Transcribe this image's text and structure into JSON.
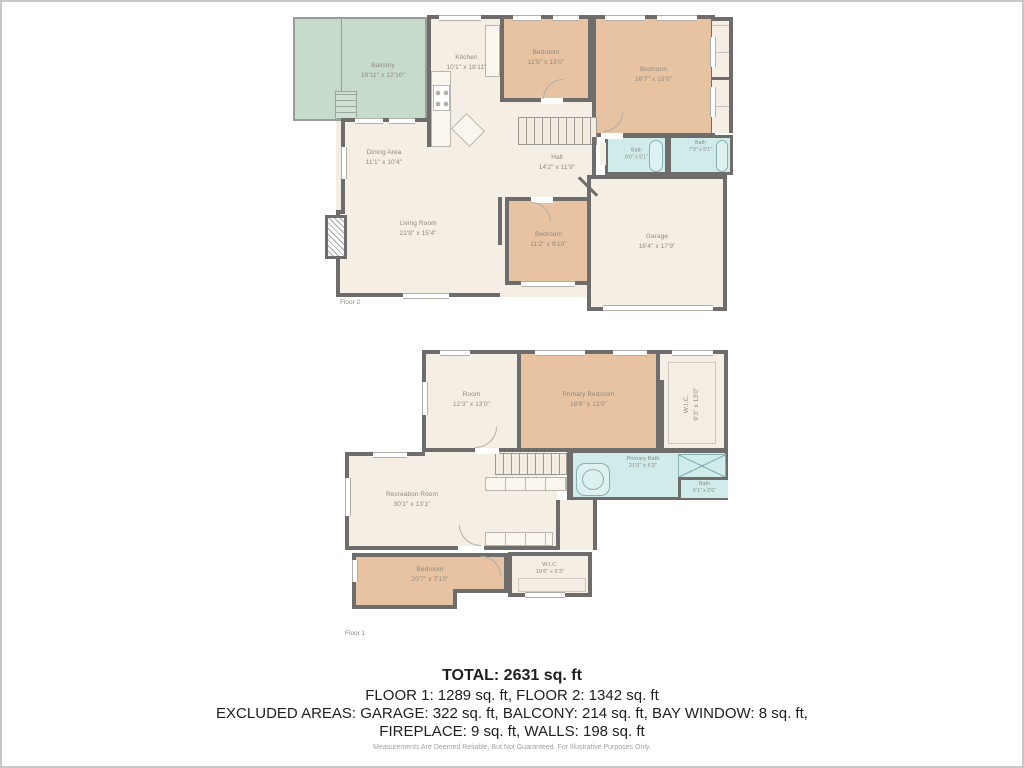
{
  "colors": {
    "wall": "#6e6d6b",
    "room_fill": "#f5eee5",
    "bedroom_fill": "#e7c3a1",
    "bath_fill": "#cfebea",
    "balcony_fill": "#c6dbca",
    "label_text": "#8e897f"
  },
  "floor2": {
    "label": "Floor 2",
    "rooms": {
      "balcony": {
        "name": "Balcony",
        "dims": "16'11\" x 12'10\""
      },
      "kitchen": {
        "name": "Kitchen",
        "dims": "10'1\" x 18'11\""
      },
      "bedroom_a": {
        "name": "Bedroom",
        "dims": "11'5\" x 13'0\""
      },
      "bedroom_b": {
        "name": "Bedroom",
        "dims": "16'7\" x 15'0\""
      },
      "dining": {
        "name": "Dining Area",
        "dims": "11'1\" x 10'4\""
      },
      "hall": {
        "name": "Hall",
        "dims": "14'2\" x 11'9\""
      },
      "bath_a": {
        "name": "Bath",
        "dims": "8'0\" x 5'1\""
      },
      "bath_b": {
        "name": "Bath",
        "dims": "7'9\" x 5'1\""
      },
      "living": {
        "name": "Living Room",
        "dims": "21'9\" x 15'4\""
      },
      "bedroom_c": {
        "name": "Bedroom",
        "dims": "11'2\" x 9'10\""
      },
      "garage": {
        "name": "Garage",
        "dims": "18'4\" x 17'9\""
      }
    }
  },
  "floor1": {
    "label": "Floor 1",
    "rooms": {
      "room": {
        "name": "Room",
        "dims": "12'3\" x 13'0\""
      },
      "primary_bedroom": {
        "name": "Primary Bedroom",
        "dims": "18'9\" x 13'0\""
      },
      "wic_upper": {
        "name": "W.I.C.",
        "dims": "9'3\" x 13'0\""
      },
      "recreation": {
        "name": "Recreation Room",
        "dims": "30'1\" x 13'1\""
      },
      "primary_bath": {
        "name": "Primary Bath",
        "dims": "21'0\" x 6'2\""
      },
      "bath_small": {
        "name": "Bath",
        "dims": "5'1\" x 2'6\""
      },
      "bedroom": {
        "name": "Bedroom",
        "dims": "20'7\" x 7'10\""
      },
      "wic_lower": {
        "name": "W.I.C.",
        "dims": "10'6\" x 6'3\""
      }
    }
  },
  "summary": {
    "total": "TOTAL: 2631 sq. ft",
    "floors": "FLOOR 1: 1289 sq. ft, FLOOR 2: 1342 sq. ft",
    "excluded1": "EXCLUDED AREAS: GARAGE: 322 sq. ft, BALCONY: 214 sq. ft, BAY WINDOW: 8 sq. ft,",
    "excluded2": "FIREPLACE: 9 sq. ft, WALLS: 198 sq. ft",
    "disclaimer": "Measurements Are Deemed Reliable, But Not Guaranteed. For Illustrative Purposes Only."
  }
}
